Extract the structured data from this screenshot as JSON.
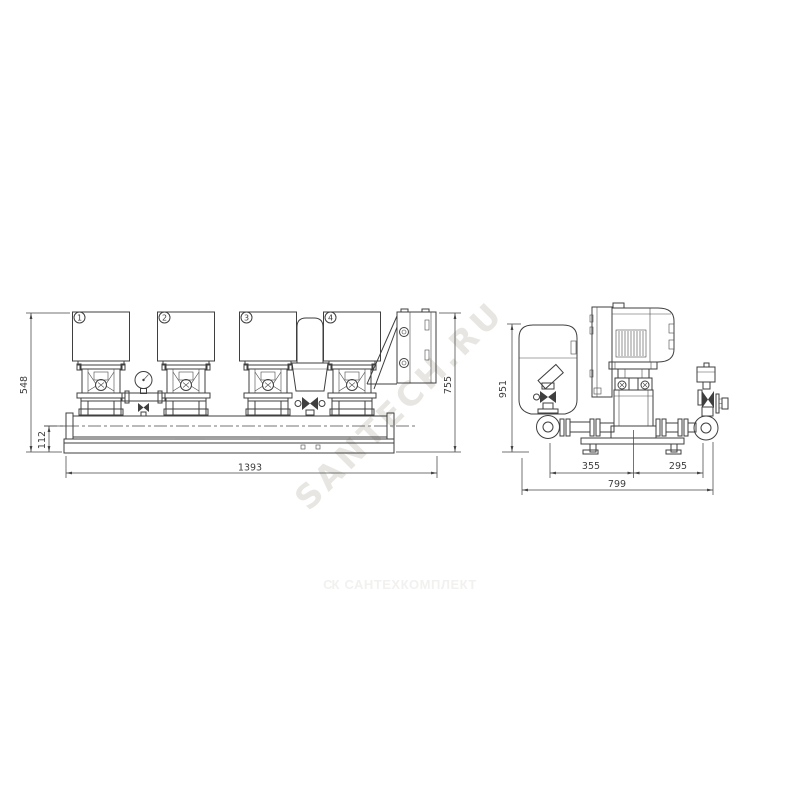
{
  "front_view": {
    "pump_labels": [
      "1",
      "2",
      "3",
      "4"
    ],
    "dim_total_height": "548",
    "dim_base_height": "112",
    "dim_total_width": "1393",
    "dim_cabinet_height": "755"
  },
  "side_view": {
    "dim_total_height": "951",
    "dim_left_span": "355",
    "dim_right_span": "295",
    "dim_total_depth": "799"
  },
  "watermarks": {
    "diagonal_text": "SANTECH.RU",
    "footer_mark": "СК",
    "footer_text": "САНТЕХКОМПЛЕКТ"
  },
  "colors": {
    "line": "#3f3f3f",
    "dimension": "#454545",
    "diagonal_watermark": "#e8e6e2",
    "footer_watermark": "#f2f1ef",
    "background": "#ffffff"
  }
}
